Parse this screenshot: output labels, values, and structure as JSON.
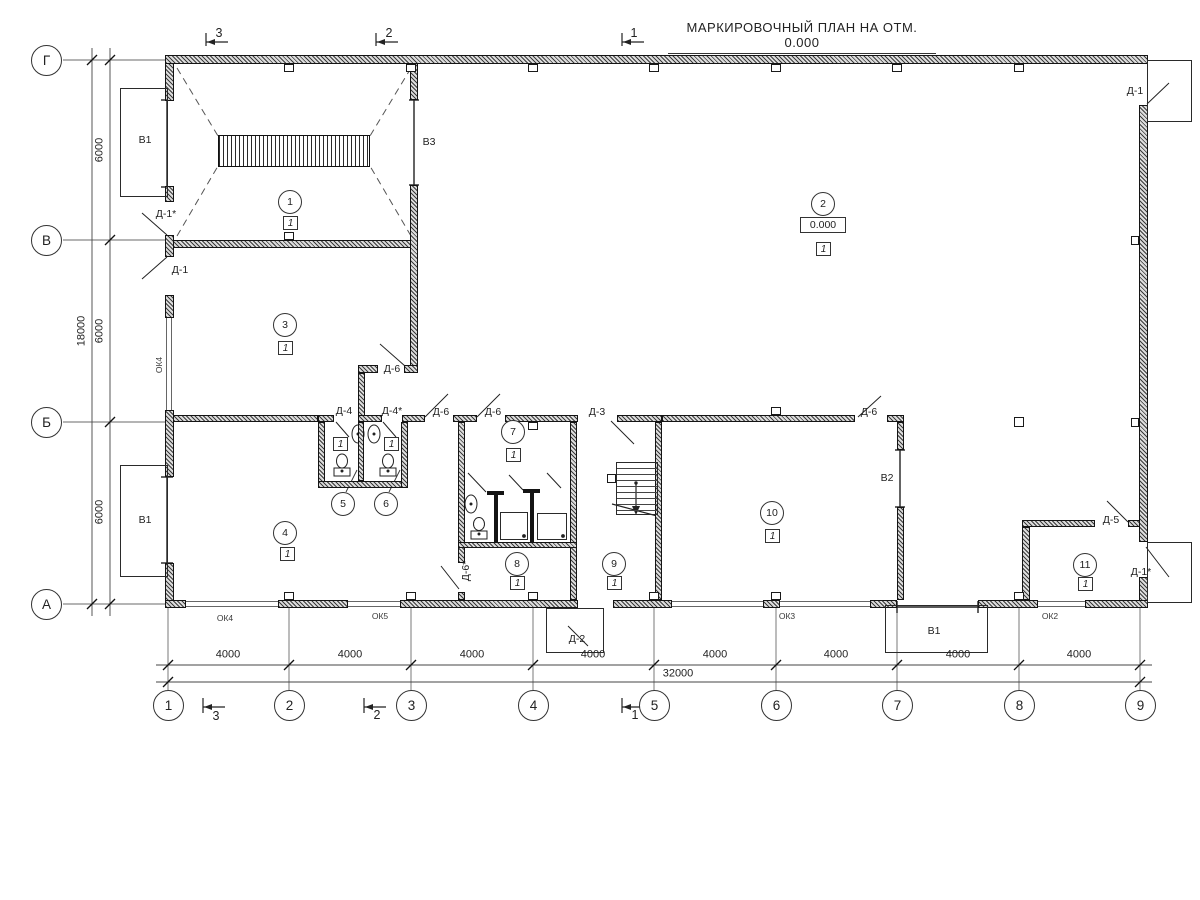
{
  "title": "МАРКИРОВОЧНЫЙ ПЛАН НА ОТМ. 0.000",
  "grid": {
    "rows": [
      {
        "label": "Г",
        "y": 60
      },
      {
        "label": "В",
        "y": 240
      },
      {
        "label": "Б",
        "y": 422
      },
      {
        "label": "А",
        "y": 604
      }
    ],
    "cols": [
      {
        "label": "1",
        "x": 168
      },
      {
        "label": "2",
        "x": 289
      },
      {
        "label": "3",
        "x": 411
      },
      {
        "label": "4",
        "x": 533
      },
      {
        "label": "5",
        "x": 654
      },
      {
        "label": "6",
        "x": 776
      },
      {
        "label": "7",
        "x": 897
      },
      {
        "label": "8",
        "x": 1019
      },
      {
        "label": "9",
        "x": 1140
      }
    ]
  },
  "dimensions": {
    "bottom_segments": [
      {
        "text": "4000",
        "x": 228,
        "y": 655
      },
      {
        "text": "4000",
        "x": 350,
        "y": 655
      },
      {
        "text": "4000",
        "x": 472,
        "y": 655
      },
      {
        "text": "4000",
        "x": 593,
        "y": 655
      },
      {
        "text": "4000",
        "x": 715,
        "y": 655
      },
      {
        "text": "4000",
        "x": 836,
        "y": 655
      },
      {
        "text": "4000",
        "x": 958,
        "y": 655
      },
      {
        "text": "4000",
        "x": 1079,
        "y": 655
      }
    ],
    "bottom_total": {
      "text": "32000",
      "x": 678,
      "y": 674
    },
    "left_segments": [
      {
        "text": "6000",
        "x": 100,
        "y": 150
      },
      {
        "text": "6000",
        "x": 100,
        "y": 331
      },
      {
        "text": "6000",
        "x": 100,
        "y": 512
      }
    ],
    "left_total": {
      "text": "18000",
      "x": 82,
      "y": 331
    }
  },
  "rooms": [
    {
      "num": "1",
      "cx": 290,
      "cy": 202,
      "floor": "1",
      "fx": 290,
      "fy": 223
    },
    {
      "num": "2",
      "cx": 823,
      "cy": 204,
      "floor": "1",
      "fx": 823,
      "fy": 249
    },
    {
      "num": "3",
      "cx": 285,
      "cy": 325,
      "floor": "1",
      "fx": 285,
      "fy": 348
    },
    {
      "num": "4",
      "cx": 285,
      "cy": 533,
      "floor": "1",
      "fx": 287,
      "fy": 554
    },
    {
      "num": "5",
      "cx": 343,
      "cy": 504,
      "floor": "1",
      "fx": 340,
      "fy": 444
    },
    {
      "num": "6",
      "cx": 386,
      "cy": 504,
      "floor": "1",
      "fx": 391,
      "fy": 444
    },
    {
      "num": "7",
      "cx": 513,
      "cy": 432,
      "floor": "1",
      "fx": 513,
      "fy": 455
    },
    {
      "num": "8",
      "cx": 517,
      "cy": 564,
      "floor": "1",
      "fx": 517,
      "fy": 583
    },
    {
      "num": "9",
      "cx": 614,
      "cy": 564,
      "floor": "1",
      "fx": 614,
      "fy": 583
    },
    {
      "num": "10",
      "cx": 772,
      "cy": 513,
      "floor": "1",
      "fx": 772,
      "fy": 536
    },
    {
      "num": "11",
      "cx": 1085,
      "cy": 565,
      "floor": "1",
      "fx": 1085,
      "fy": 584
    }
  ],
  "elevation": {
    "text": "0.000",
    "x": 823,
    "y": 225
  },
  "labels": [
    {
      "name": "door-label-d1star-left",
      "text": "Д-1*",
      "x": 166,
      "y": 214
    },
    {
      "name": "door-label-d1-left",
      "text": "Д-1",
      "x": 180,
      "y": 270
    },
    {
      "name": "door-label-d6-room3",
      "text": "Д-6",
      "x": 392,
      "y": 369
    },
    {
      "name": "door-label-d4",
      "text": "Д-4",
      "x": 344,
      "y": 411
    },
    {
      "name": "door-label-d4star",
      "text": "Д-4*",
      "x": 392,
      "y": 411
    },
    {
      "name": "door-label-d6-room4",
      "text": "Д-6",
      "x": 441,
      "y": 412
    },
    {
      "name": "door-label-d6-room7",
      "text": "Д-6",
      "x": 493,
      "y": 412
    },
    {
      "name": "door-label-d3",
      "text": "Д-3",
      "x": 597,
      "y": 412
    },
    {
      "name": "door-label-d6-room10",
      "text": "Д-6",
      "x": 869,
      "y": 412
    },
    {
      "name": "door-label-d6star",
      "text": "Д-6*",
      "x": 466,
      "y": 571,
      "rot": -90
    },
    {
      "name": "door-label-d2",
      "text": "Д-2",
      "x": 577,
      "y": 639
    },
    {
      "name": "door-label-d5",
      "text": "Д-5",
      "x": 1111,
      "y": 520
    },
    {
      "name": "door-label-d1-topright",
      "text": "Д-1",
      "x": 1135,
      "y": 91
    },
    {
      "name": "door-label-d1star-bottomright",
      "text": "Д-1*",
      "x": 1141,
      "y": 572
    },
    {
      "name": "vent-label-v1-topleft",
      "text": "В1",
      "x": 145,
      "y": 140
    },
    {
      "name": "vent-label-v1-bottomleft",
      "text": "В1",
      "x": 145,
      "y": 520
    },
    {
      "name": "vent-label-v1-bottom",
      "text": "В1",
      "x": 934,
      "y": 631
    },
    {
      "name": "vent-label-v2",
      "text": "В2",
      "x": 887,
      "y": 478
    },
    {
      "name": "vent-label-v3",
      "text": "В3",
      "x": 429,
      "y": 142
    },
    {
      "name": "window-label-ok4-leftwall",
      "text": "ОК4",
      "x": 159,
      "y": 365,
      "rot": -90,
      "cls": "small"
    },
    {
      "name": "window-label-ok4",
      "text": "ОК4",
      "x": 225,
      "y": 618,
      "cls": "small"
    },
    {
      "name": "window-label-ok5",
      "text": "ОК5",
      "x": 380,
      "y": 616,
      "cls": "small"
    },
    {
      "name": "window-label-ok3",
      "text": "ОК3",
      "x": 787,
      "y": 616,
      "cls": "small"
    },
    {
      "name": "window-label-ok2",
      "text": "ОК2",
      "x": 1050,
      "y": 616,
      "cls": "small"
    }
  ],
  "section_marks": {
    "top": [
      {
        "num": "3",
        "x": 206,
        "y": 42,
        "tx": 219,
        "ty": 33
      },
      {
        "num": "2",
        "x": 376,
        "y": 42,
        "tx": 389,
        "ty": 33
      },
      {
        "num": "1",
        "x": 622,
        "y": 42,
        "tx": 634,
        "ty": 33
      }
    ],
    "bottom": [
      {
        "num": "3",
        "x": 203,
        "y": 707,
        "tx": 216,
        "ty": 716
      },
      {
        "num": "2",
        "x": 364,
        "y": 707,
        "tx": 377,
        "ty": 715
      },
      {
        "num": "1",
        "x": 622,
        "y": 707,
        "tx": 635,
        "ty": 715
      }
    ]
  }
}
